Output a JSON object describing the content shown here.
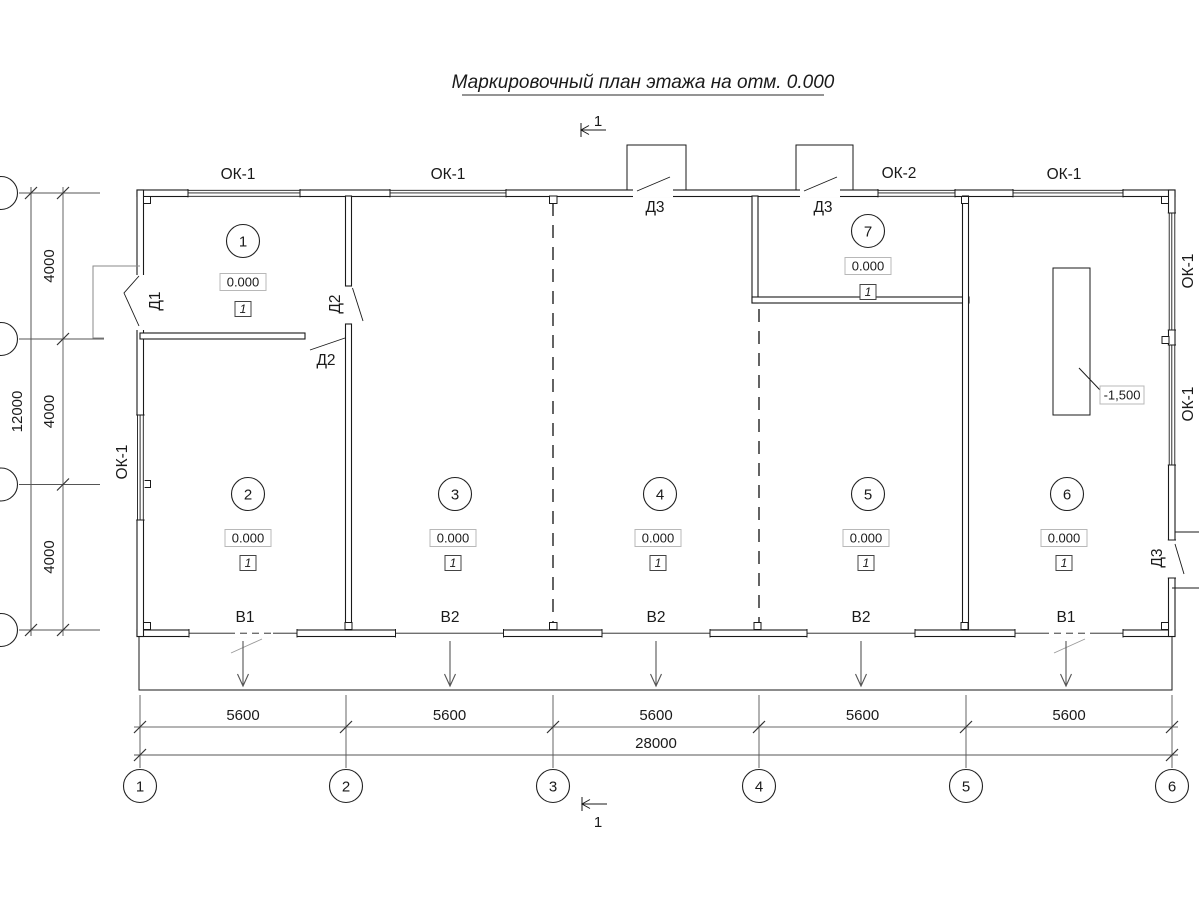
{
  "title": "Маркировочный план этажа на отм. 0.000",
  "section_marks": {
    "top": "1",
    "bottom": "1"
  },
  "rooms": [
    {
      "number": "1",
      "elevation": "0.000",
      "finish_mark": "1"
    },
    {
      "number": "2",
      "elevation": "0.000",
      "finish_mark": "1"
    },
    {
      "number": "3",
      "elevation": "0.000",
      "finish_mark": "1"
    },
    {
      "number": "4",
      "elevation": "0.000",
      "finish_mark": "1"
    },
    {
      "number": "5",
      "elevation": "0.000",
      "finish_mark": "1"
    },
    {
      "number": "6",
      "elevation": "0.000",
      "finish_mark": "1"
    },
    {
      "number": "7",
      "elevation": "0.000",
      "finish_mark": "1"
    }
  ],
  "windows": [
    {
      "label": "ОК-1",
      "location": "top-bay-1"
    },
    {
      "label": "ОК-1",
      "location": "top-bay-2"
    },
    {
      "label": "ОК-2",
      "location": "top-bay-4"
    },
    {
      "label": "ОК-1",
      "location": "top-bay-5"
    },
    {
      "label": "ОК-1",
      "location": "left-wall"
    },
    {
      "label": "ОК-1",
      "location": "right-wall-upper"
    },
    {
      "label": "ОК-1",
      "location": "right-wall-lower"
    }
  ],
  "doors": [
    {
      "label": "Д1",
      "location": "left-wall"
    },
    {
      "label": "Д2",
      "location": "room1-right-wall"
    },
    {
      "label": "Д2",
      "location": "room1-bottom-wall"
    },
    {
      "label": "Д3",
      "location": "top-bay-3"
    },
    {
      "label": "Д3",
      "location": "top-bay-4"
    },
    {
      "label": "Д3",
      "location": "right-wall"
    }
  ],
  "gates": [
    {
      "label": "В1"
    },
    {
      "label": "В2"
    },
    {
      "label": "В2"
    },
    {
      "label": "В2"
    },
    {
      "label": "В1"
    }
  ],
  "pit": {
    "elevation": "-1,500"
  },
  "axes": {
    "bottom": [
      "1",
      "2",
      "3",
      "4",
      "5",
      "6"
    ]
  },
  "dimensions": {
    "bottom_bays": [
      "5600",
      "5600",
      "5600",
      "5600",
      "5600"
    ],
    "bottom_total": "28000",
    "left_bays": [
      "4000",
      "4000",
      "4000"
    ],
    "left_total": "12000"
  }
}
